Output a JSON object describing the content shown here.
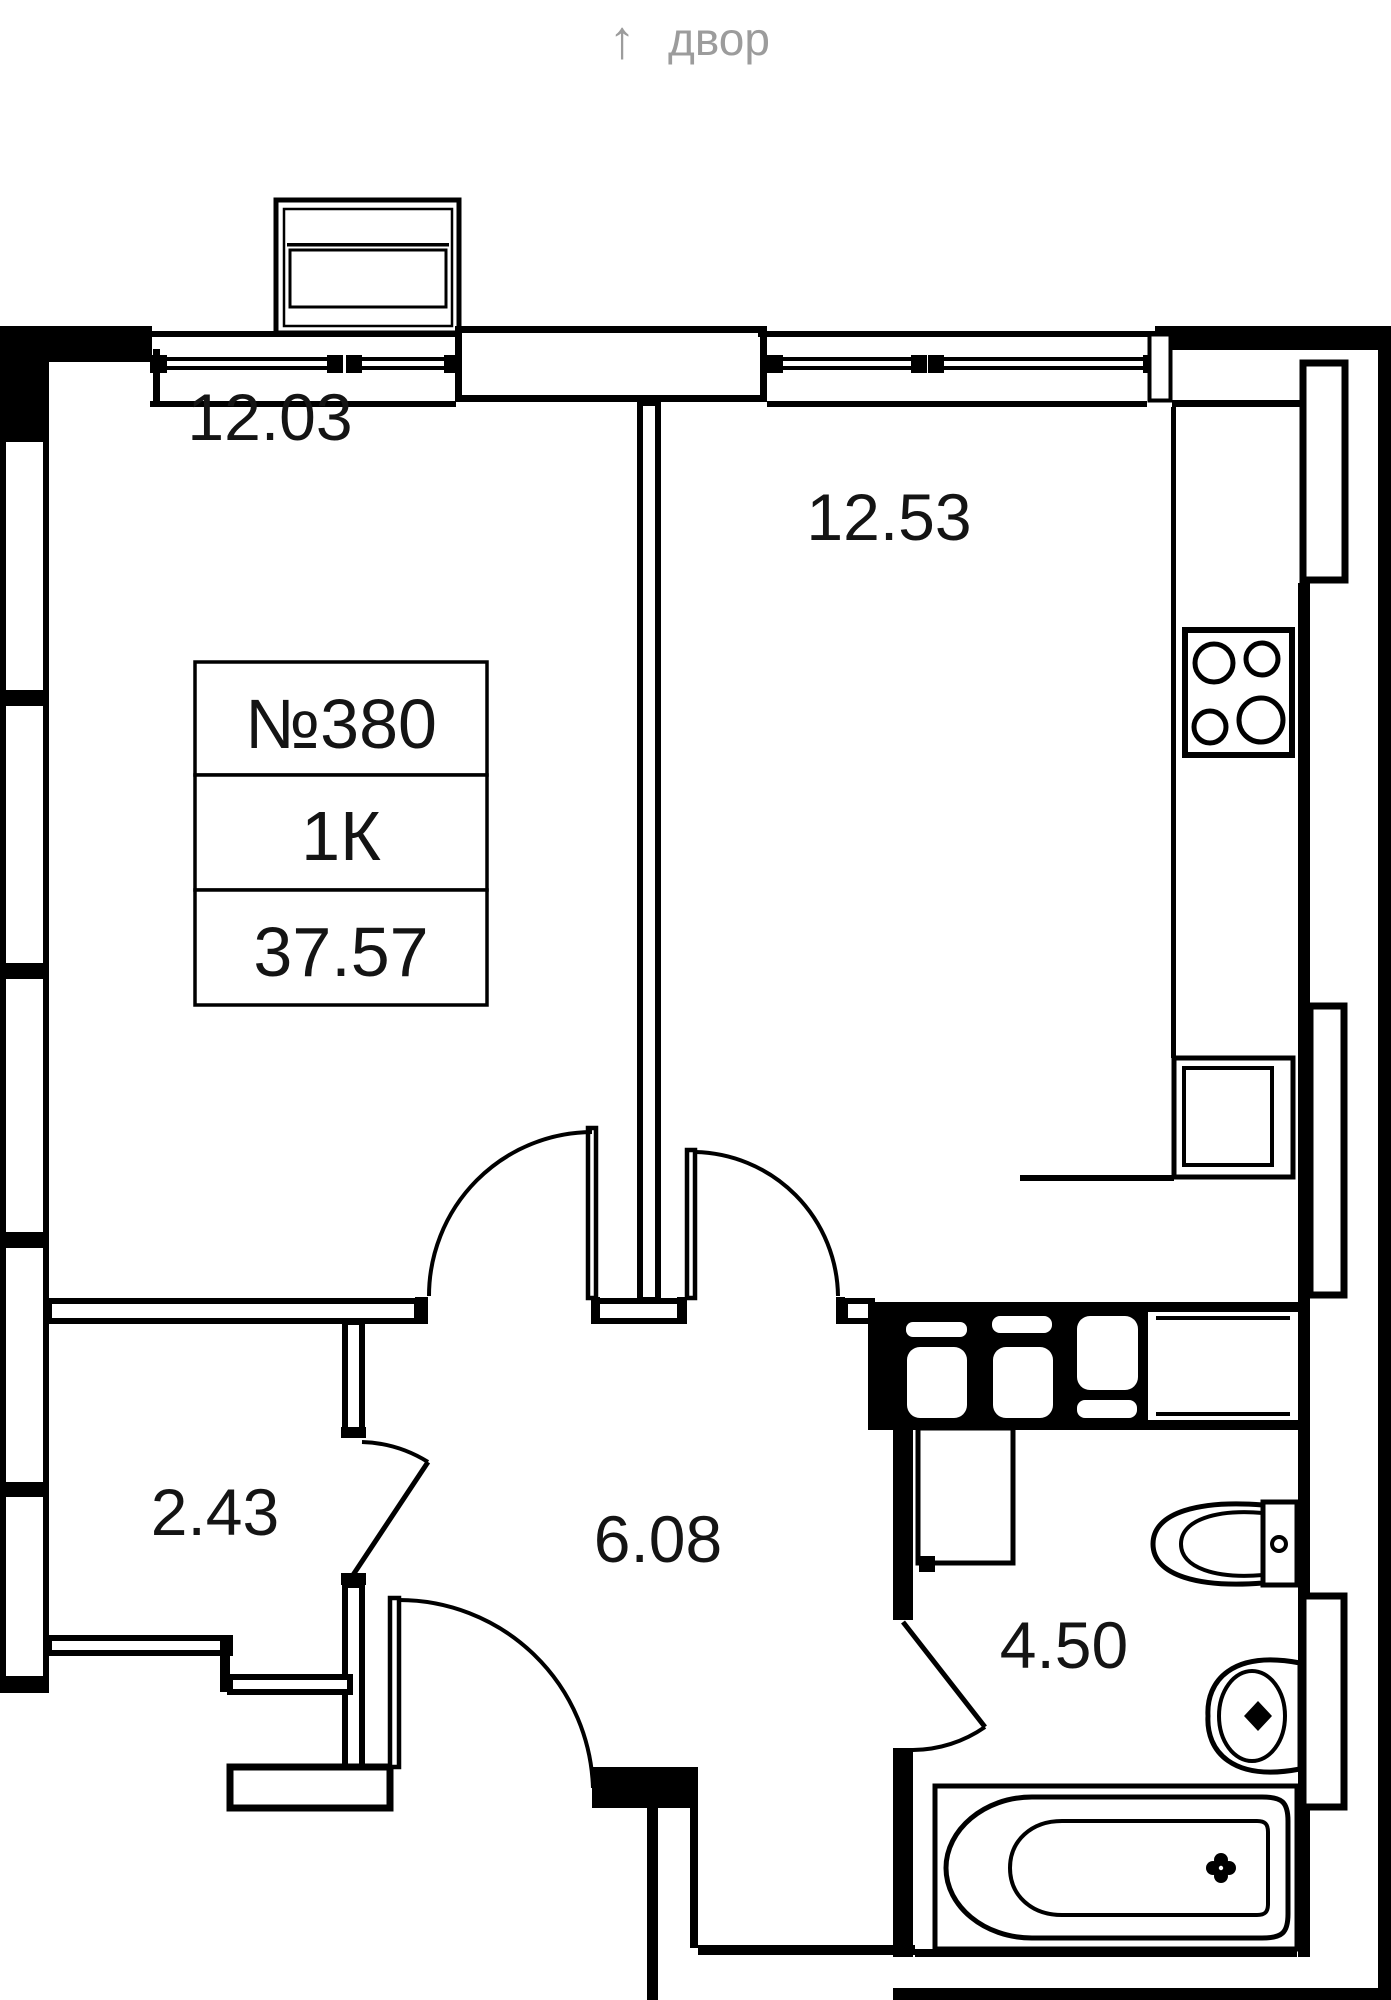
{
  "orientation": {
    "arrow_glyph": "↑",
    "label": "двор"
  },
  "apartment": {
    "number_label": "№380",
    "layout_label": "1К",
    "total_area_label": "37.57"
  },
  "areas": {
    "living": "12.03",
    "kitchen": "12.53",
    "closet": "2.43",
    "hall": "6.08",
    "bathroom": "4.50"
  },
  "colors": {
    "walls": "#000000",
    "background": "#ffffff",
    "muted_text": "#9c9c9c",
    "label_text": "#141414"
  }
}
